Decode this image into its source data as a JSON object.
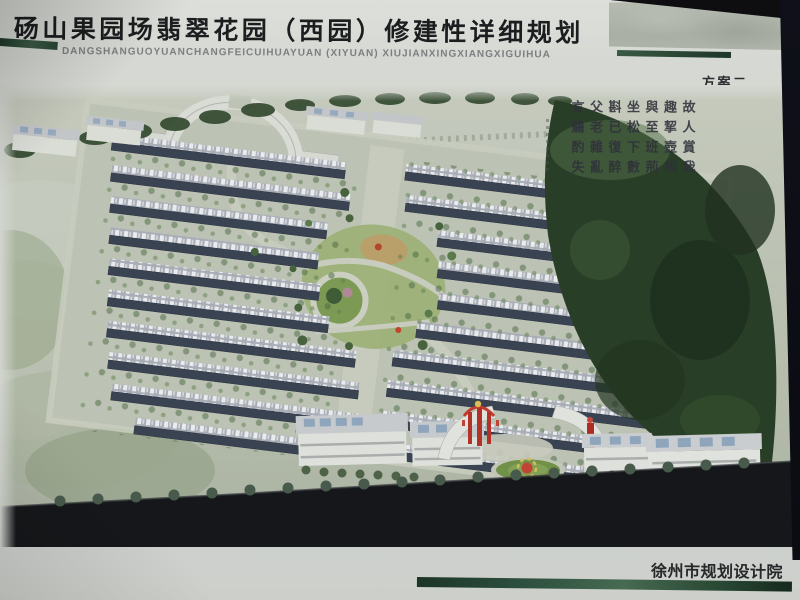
{
  "poster": {
    "header": {
      "title": "砀山果园场翡翠花园（西园）修建性详细规划",
      "title_pinyin": "DANGSHANGUOYUANCHANGFEICUIHUAYUAN (XIYUAN) XIUJIANXINGXIANGXIGUIHUA",
      "scheme_label": "方案二"
    },
    "rendering": {
      "calligraphy_poem": "故人賞我趣挈壺相與至班荊坐松下數斟已復醉父老雜亂言觴酌失",
      "calligraphy_poem_columns": [
        "故人賞我",
        "趣挈壺相",
        "與至班荊",
        "坐松下數",
        "斟已復醉",
        "父老雜亂",
        "言觴酌失"
      ]
    },
    "footer": {
      "institute": "徐州市规划设计院"
    },
    "colors": {
      "banner_green_dark": "#1d3629",
      "banner_green_light": "#476a52",
      "paper": "#d6d8d3",
      "roof_slate": "#3a4352",
      "foliage_dark": "#283e27",
      "lawn_green": "#83a156",
      "accent_red": "#b23227",
      "skylight_blue": "#8fa5bb"
    }
  }
}
